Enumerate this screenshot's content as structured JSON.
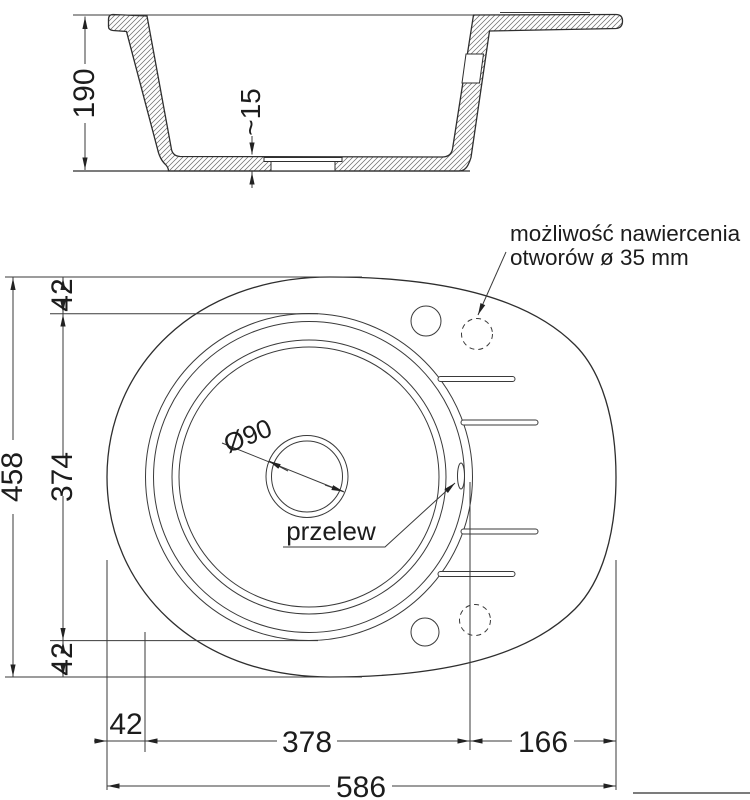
{
  "drawing": {
    "type": "sink-technical-drawing",
    "views": [
      "cross-section",
      "plan"
    ]
  },
  "dims": {
    "depth": "190",
    "bottom_thickness": "~15",
    "overall_height": "458",
    "top_offset": "42",
    "bowl_height": "374",
    "bottom_offset": "42",
    "left_offset": "42",
    "bowl_width": "378",
    "drainer_width": "166",
    "overall_width": "586"
  },
  "labels": {
    "drill_note_line1": "możliwość nawiercenia",
    "drill_note_line2": "otworów ø 35 mm",
    "overflow": "przelew",
    "drain_diameter": "Ø90"
  },
  "colors": {
    "line": "#2e2e2e",
    "background": "#ffffff"
  }
}
